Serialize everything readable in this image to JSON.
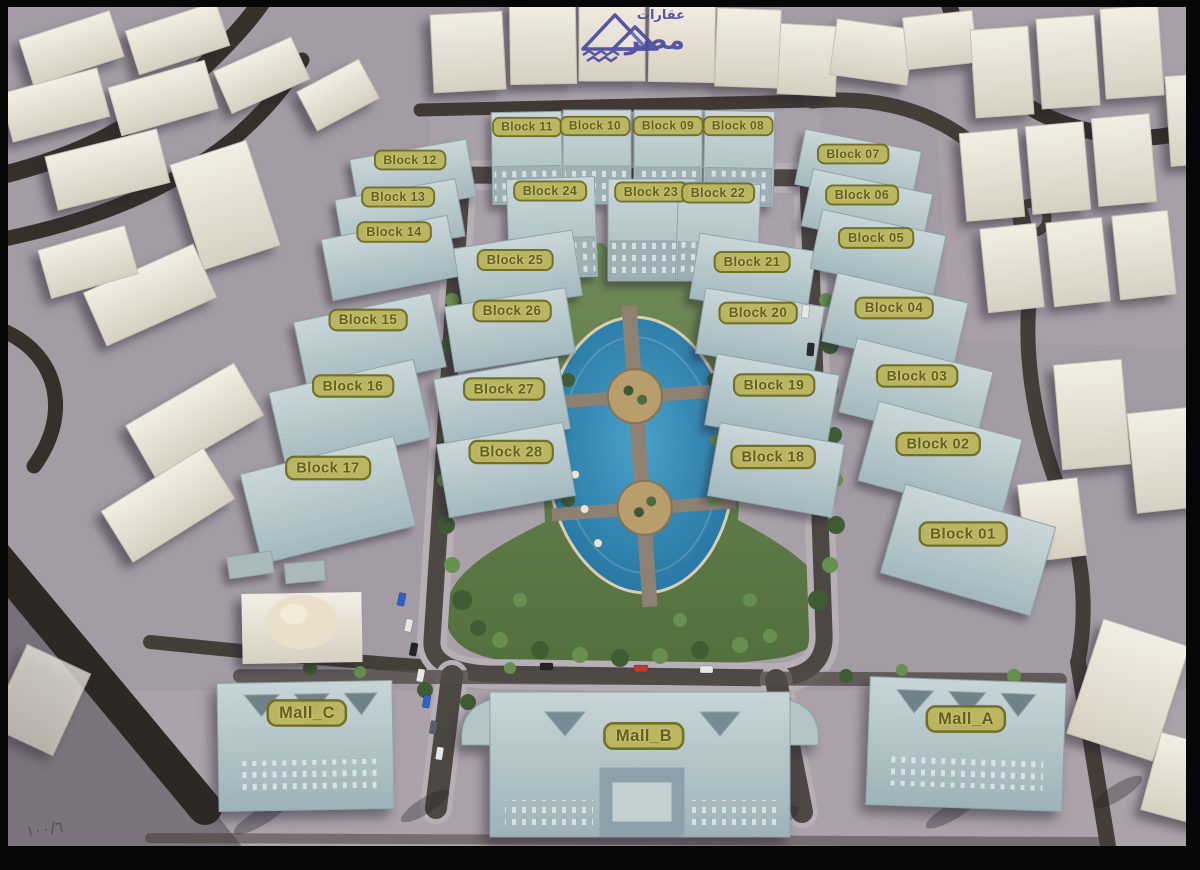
{
  "scene": {
    "logo": {
      "word_top": "عقارات",
      "word_main": "مصر"
    },
    "watermark": "١٠٠/٦",
    "colors": {
      "ground": "#a49ca5",
      "road": "#3a322d",
      "label_bg": "#b9b45c",
      "label_border": "#6e6c1e",
      "label_text": "#5d5c12",
      "building_blue": "#b7c8cc",
      "building_cream": "#ece7dc",
      "pool_blue": "#2e84b3",
      "park_green": "#64804d",
      "logo_blue": "#4b4aa0"
    }
  },
  "labels": [
    {
      "text": "Block 11",
      "x": 527,
      "y": 127
    },
    {
      "text": "Block 10",
      "x": 595,
      "y": 126
    },
    {
      "text": "Block 09",
      "x": 668,
      "y": 126
    },
    {
      "text": "Block 08",
      "x": 738,
      "y": 126
    },
    {
      "text": "Block 24",
      "x": 550,
      "y": 191
    },
    {
      "text": "Block 23",
      "x": 651,
      "y": 192
    },
    {
      "text": "Block 22",
      "x": 718,
      "y": 193
    },
    {
      "text": "Block 12",
      "x": 410,
      "y": 160
    },
    {
      "text": "Block 13",
      "x": 398,
      "y": 197
    },
    {
      "text": "Block 14",
      "x": 394,
      "y": 232
    },
    {
      "text": "Block 15",
      "x": 368,
      "y": 320
    },
    {
      "text": "Block 16",
      "x": 353,
      "y": 386
    },
    {
      "text": "Block 17",
      "x": 328,
      "y": 468
    },
    {
      "text": "Block 25",
      "x": 515,
      "y": 260
    },
    {
      "text": "Block 26",
      "x": 512,
      "y": 311
    },
    {
      "text": "Block 27",
      "x": 504,
      "y": 389
    },
    {
      "text": "Block 28",
      "x": 511,
      "y": 452
    },
    {
      "text": "Block 21",
      "x": 752,
      "y": 262
    },
    {
      "text": "Block 20",
      "x": 758,
      "y": 313
    },
    {
      "text": "Block 19",
      "x": 774,
      "y": 385
    },
    {
      "text": "Block 18",
      "x": 773,
      "y": 457
    },
    {
      "text": "Block 07",
      "x": 853,
      "y": 154
    },
    {
      "text": "Block 06",
      "x": 862,
      "y": 195
    },
    {
      "text": "Block 05",
      "x": 876,
      "y": 238
    },
    {
      "text": "Block 04",
      "x": 894,
      "y": 308
    },
    {
      "text": "Block 03",
      "x": 917,
      "y": 376
    },
    {
      "text": "Block 02",
      "x": 938,
      "y": 444
    },
    {
      "text": "Block 01",
      "x": 963,
      "y": 534
    },
    {
      "text": "Mall_C",
      "x": 307,
      "y": 713
    },
    {
      "text": "Mall_B",
      "x": 644,
      "y": 736
    },
    {
      "text": "Mall_A",
      "x": 966,
      "y": 719
    }
  ]
}
